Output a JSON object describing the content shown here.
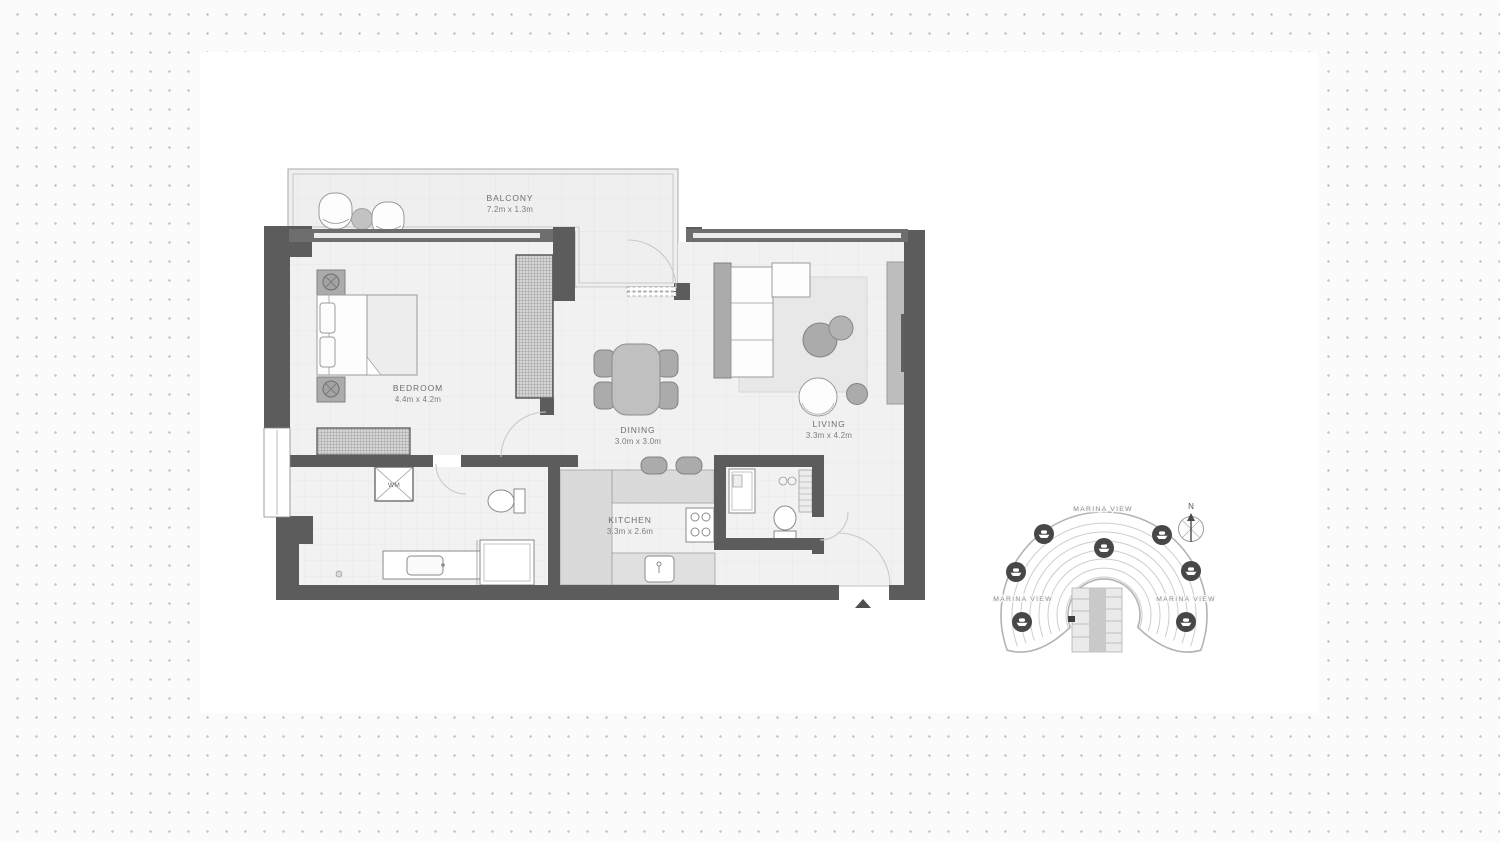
{
  "page": {
    "background_color": "#fbfbfb",
    "dot_color": "#c3c3c3",
    "board_color": "#ffffff"
  },
  "floor_plan": {
    "wall_color": "#5c5c5c",
    "floor_color": "#f1f1f1",
    "rooms": [
      {
        "name": "BALCONY",
        "dimensions": "7.2m x 1.3m"
      },
      {
        "name": "BEDROOM",
        "dimensions": "4.4m x 4.2m"
      },
      {
        "name": "DINING",
        "dimensions": "3.0m x 3.0m"
      },
      {
        "name": "LIVING",
        "dimensions": "3.3m x 4.2m"
      },
      {
        "name": "KITCHEN",
        "dimensions": "3.3m x 2.6m"
      }
    ],
    "appliances": {
      "washing_machine_label": "WM"
    }
  },
  "site_map": {
    "view_labels": {
      "top": "MARINA VIEW",
      "left": "MARINA VIEW",
      "right": "MARINA VIEW"
    },
    "compass_label": "N",
    "boat_marker_count": 7,
    "marker_color": "#474747",
    "water_line_color": "#cdcdcd"
  }
}
